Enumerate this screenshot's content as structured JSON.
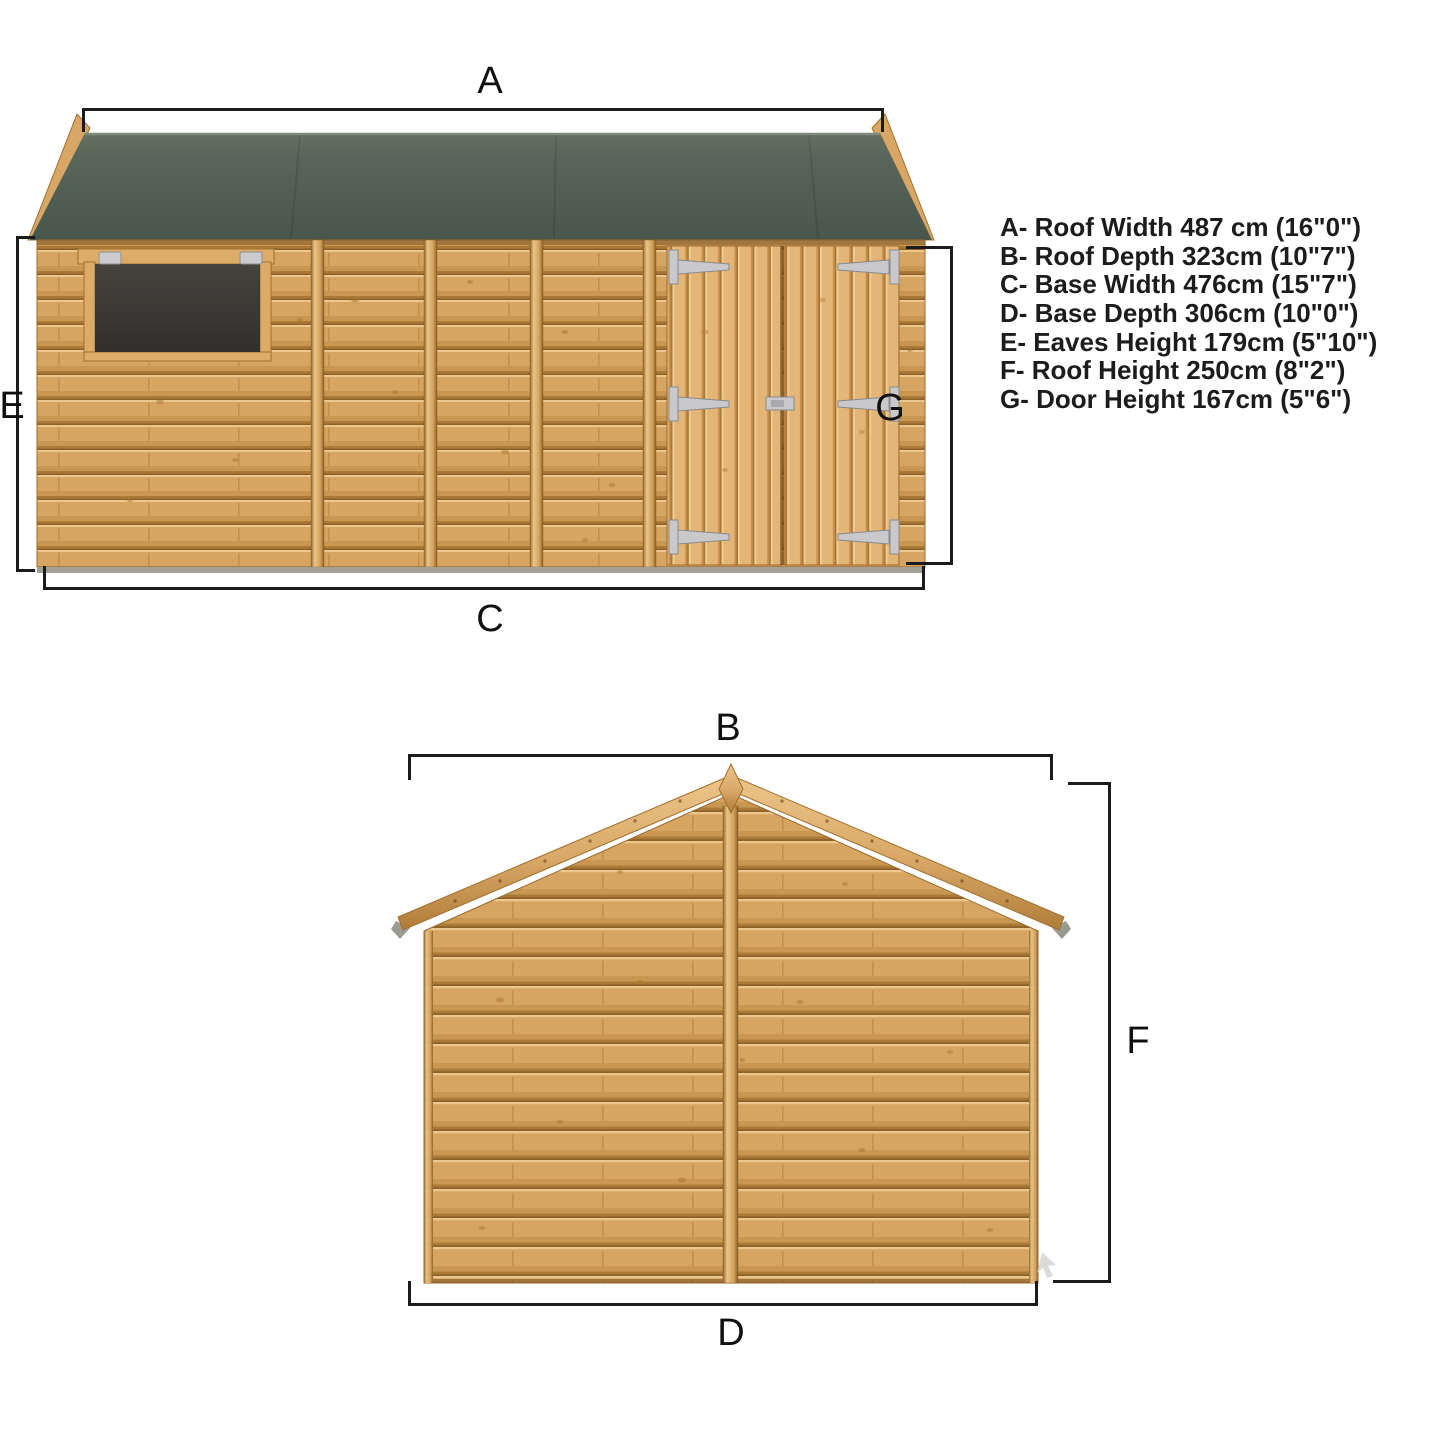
{
  "legend": {
    "items": [
      {
        "letter": "A",
        "name": "Roof Width",
        "metric": "487 cm",
        "imperial": "16\"0\"",
        "text": "A- Roof Width 487 cm (16\"0\")"
      },
      {
        "letter": "B",
        "name": "Roof Depth",
        "metric": "323cm",
        "imperial": "10\"7\"",
        "text": "B- Roof Depth 323cm (10\"7\")"
      },
      {
        "letter": "C",
        "name": "Base Width",
        "metric": "476cm",
        "imperial": "15\"7\"",
        "text": "C- Base Width 476cm (15\"7\")"
      },
      {
        "letter": "D",
        "name": "Base Depth",
        "metric": "306cm",
        "imperial": "10\"0\"",
        "text": "D- Base Depth 306cm (10\"0\")"
      },
      {
        "letter": "E",
        "name": "Eaves Height",
        "metric": "179cm",
        "imperial": "5\"10\"",
        "text": "E- Eaves Height 179cm (5\"10\")"
      },
      {
        "letter": "F",
        "name": "Roof Height",
        "metric": "250cm",
        "imperial": "8\"2\"",
        "text": "F- Roof Height 250cm (8\"2\")"
      },
      {
        "letter": "G",
        "name": "Door Height",
        "metric": "167cm",
        "imperial": "5\"6\"",
        "text": "G- Door Height 167cm (5\"6\")"
      }
    ]
  },
  "markers": {
    "roof_width": "A",
    "roof_depth": "B",
    "base_width": "C",
    "base_depth": "D",
    "eaves_height": "E",
    "roof_height": "F",
    "door_height": "G"
  },
  "colors": {
    "roof_felt_green": "#536152",
    "wall_wood": "#d7a562",
    "door_wood": "#e3b577",
    "batten_wood": "#c89051",
    "metal_fitting": "#c9c9cb",
    "window_glass": "#3a3734",
    "base_strip": "#a19f96",
    "dimension_line": "#1b1b1b",
    "background": "#ffffff"
  }
}
